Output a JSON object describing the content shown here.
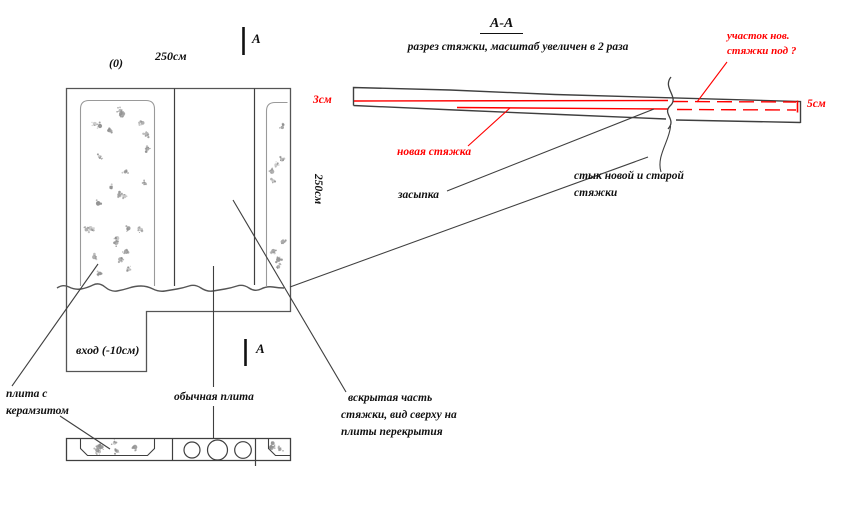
{
  "drawing": {
    "section": {
      "title": "А-А",
      "subtitle": "разрез стяжки, масштаб увеличен в 2 раза",
      "patch_label_line1": "участок нов.",
      "patch_label_line2": "стяжки под ?",
      "dim_left": "3см",
      "dim_right": "5см",
      "new_screed_label": "новая стяжка",
      "backfill_label": "засыпка",
      "joint_label_line1": "стык новой и старой",
      "joint_label_line2": "стяжки"
    },
    "plan": {
      "elevation_mark": "(0)",
      "width_dim": "250см",
      "depth_dim": "250см",
      "section_mark": "А",
      "entrance_label": "вход (-10см)",
      "claydite_label_line1": "плита с",
      "claydite_label_line2": "керамзитом",
      "regular_slab_label": "обычная плита",
      "opened_label_line1": "вскрытая часть",
      "opened_label_line2": "стяжки, вид сверху на",
      "opened_label_line3": "плиты перекрытия"
    },
    "colors": {
      "annotation_red": "#ff0000",
      "line_dark": "#3f3f3f"
    }
  }
}
